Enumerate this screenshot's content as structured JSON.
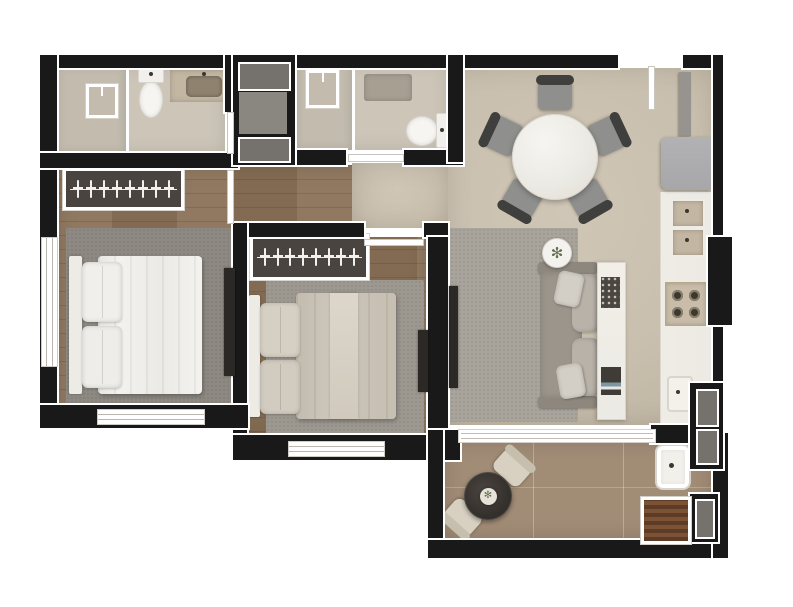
{
  "meta": {
    "type": "apartment-floor-plan",
    "view": "top-down-render",
    "width_px": 793,
    "height_px": 607
  },
  "palette": {
    "wall": "#191919",
    "floor_wood": "#8a7258",
    "floor_bath": "#ccc5b8",
    "floor_shower": "#c2bbae",
    "floor_living": "#c9bfae",
    "floor_balcony": "#a18c76",
    "rug_bed1": "#8e8a83",
    "rug_bed2": "#9d9890",
    "rug_living": "#a9a49c",
    "bed_white": "#f3f2ef",
    "bed_beige": "#ccc5b9",
    "wardrobe": "#4a4440",
    "marble": "#eceae4",
    "counter_tan": "#c3b7a3",
    "fridge": "#a7a7a9",
    "sofa": "#9b958c",
    "sofa_cushion": "#b8b2a9",
    "dark_furniture": "#2b2825",
    "chair_dark": "#3f3f3d",
    "chair_seat": "#8f8f8d",
    "balcony_chair": "#d8d1c2",
    "table_dark": "#332f2b",
    "grill": "#7b5235",
    "shaft_gray": "#75716c",
    "shaft_light": "#8a8680",
    "mat": "#a79f92",
    "plant": "#5f7050"
  },
  "rooms": {
    "bathroom_suite": {
      "fixtures": [
        "walk-in-shower",
        "toilet",
        "vanity-with-sink"
      ]
    },
    "bedroom_1": {
      "furniture": [
        "wardrobe-rail",
        "double-bed-white",
        "area-rug",
        "tv-panel"
      ],
      "wardrobe_hangers": 8,
      "windows": 2
    },
    "hallway": {
      "floor": "wood-to-stone-transition"
    },
    "bathroom_2": {
      "fixtures": [
        "walk-in-shower",
        "bath-mat",
        "toilet"
      ]
    },
    "bedroom_2": {
      "furniture": [
        "wardrobe-rail",
        "double-bed-beige",
        "area-rug",
        "tv-panel"
      ],
      "wardrobe_hangers": 8,
      "windows": 1
    },
    "living_dining": {
      "furniture": [
        "round-dining-table",
        "dining-chairs",
        "sofa",
        "side-table-with-plant",
        "area-rug",
        "sideboard",
        "tv-panel"
      ],
      "dining_chairs": 5
    },
    "kitchen": {
      "appliances": [
        "tall-cabinet",
        "refrigerator",
        "double-basin-sink",
        "gas-cooktop",
        "stone-counter",
        "prep-sink"
      ],
      "cooktop_burners": 4
    },
    "balcony": {
      "furniture": [
        "round-bistro-table",
        "bistro-chairs",
        "table-plant",
        "laundry-sink",
        "barbecue-grill"
      ],
      "bistro_chairs": 2
    },
    "service_shafts": {
      "count": 3
    }
  },
  "glyphs": {
    "plant": "✻"
  }
}
